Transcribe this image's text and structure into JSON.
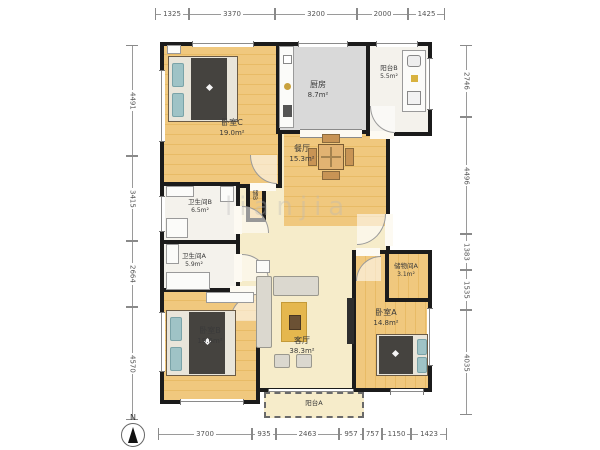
{
  "watermark": "lianjia",
  "compass": {
    "label": "N"
  },
  "dimensions": {
    "top": [
      "1325",
      "3370",
      "3200",
      "2000",
      "1425"
    ],
    "bottom": [
      "3700",
      "935",
      "2463",
      "957",
      "757",
      "1150",
      "1423"
    ],
    "left": [
      "4491",
      "3415",
      "2664",
      "4570"
    ],
    "right": [
      "2746",
      "4496",
      "1383",
      "1535",
      "4035"
    ]
  },
  "rooms": {
    "bedroom_c": {
      "name": "卧室C",
      "area": "19.0m²"
    },
    "kitchen": {
      "name": "厨房",
      "area": "8.7m²"
    },
    "balcony_b": {
      "name": "阳台B",
      "area": "5.5m²"
    },
    "dining": {
      "name": "餐厅",
      "area": "15.3m²"
    },
    "bath_b": {
      "name": "卫生间B",
      "area": "6.5m²"
    },
    "bath_a": {
      "name": "卫生间A",
      "area": "5.9m²"
    },
    "living": {
      "name": "客厅",
      "area": "38.3m²"
    },
    "closet_b": {
      "name": "储B"
    },
    "storage_a": {
      "name": "储物间A",
      "area": "3.1m²"
    },
    "bedroom_a": {
      "name": "卧室A",
      "area": "14.8m²"
    },
    "bedroom_b": {
      "name": "卧室B",
      "area": "19.6m²"
    },
    "balcony_a": {
      "name": "阳台A"
    }
  }
}
